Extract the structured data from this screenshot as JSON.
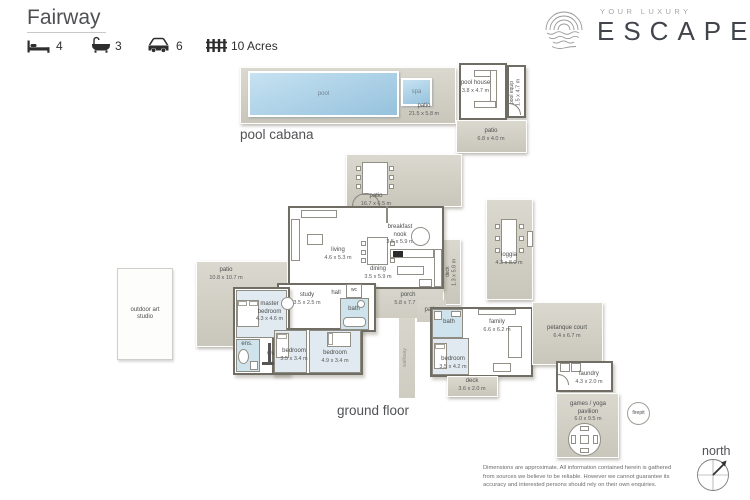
{
  "header": {
    "title": "Fairway",
    "beds": "4",
    "baths": "3",
    "cars": "6",
    "land": "10 Acres"
  },
  "logo": {
    "tagline": "YOUR LUXURY",
    "brand": "ESCAPE"
  },
  "pool_cabana": {
    "section_label": "pool cabana",
    "pool": "pool",
    "spa": "spa",
    "patio": {
      "name": "patio",
      "dims": "21.5 x 5.8 m"
    }
  },
  "pool_house": {
    "room": {
      "name": "pool house",
      "dims": "3.8 x 4.7 m"
    },
    "equip": {
      "name": "pool equip",
      "dims": "1.5 x 4.7 m"
    },
    "patio": {
      "name": "patio",
      "dims": "6.8 x 4.0 m"
    }
  },
  "gf": {
    "section_label": "ground floor",
    "patio_top": {
      "name": "patio",
      "dims": "16.7 x 6.5 m"
    },
    "living": {
      "name": "living",
      "dims": "4.6 x 5.3 m"
    },
    "dining": {
      "name": "dining",
      "dims": "3.5 x 5.9 m"
    },
    "breakfast": {
      "name": "breakfast nook",
      "dims": "3.5 x 5.9 m"
    },
    "porch": {
      "name": "porch",
      "dims": "5.8 x 7.7 m"
    },
    "patio_small": {
      "name": "patio"
    },
    "deck_side": {
      "name": "deck",
      "dims": "1.3 x 5.8 m"
    },
    "loggia": {
      "name": "loggia",
      "dims": "4.3 x 8.0 m"
    },
    "patio_left": {
      "name": "patio",
      "dims": "10.8 x 10.7 m"
    },
    "art_studio": {
      "name": "outdoor art studio"
    },
    "master": {
      "name": "master bedroom",
      "dims": "4.3 x 4.6 m"
    },
    "study": {
      "name": "study",
      "dims": "3.5 x 2.5 m"
    },
    "hall": {
      "name": "hall"
    },
    "wc": {
      "name": "wc"
    },
    "bath_main": {
      "name": "bath"
    },
    "ens": {
      "name": "ens."
    },
    "wir": {
      "name": "wir"
    },
    "bedroom2": {
      "name": "bedroom",
      "dims": "3.5 x 3.4 m"
    },
    "bedroom3": {
      "name": "bedroom",
      "dims": "4.9 x 3.4 m"
    },
    "bath_family": {
      "name": "bath"
    },
    "family": {
      "name": "family",
      "dims": "6.6 x 6.2 m"
    },
    "bedroom4": {
      "name": "bedroom",
      "dims": "3.5 x 4.2 m"
    },
    "deck_bottom": {
      "name": "deck",
      "dims": "3.6 x 2.0 m"
    },
    "petanque": {
      "name": "petanque court",
      "dims": "6.4 x 6.7 m"
    },
    "laundry": {
      "name": "laundry",
      "dims": "4.3 x 2.0 m"
    },
    "pavilion": {
      "name": "games / yoga pavilion",
      "dims": "6.0 x 9.5 m"
    },
    "firepit": {
      "name": "firepit"
    },
    "walkway": {
      "name": "walkway"
    }
  },
  "footer": {
    "disclaimer": [
      "Dimensions are approximate.  All information contained herein is gathered",
      "from sources we believe to be reliable.  However we cannot guarantee its",
      "accuracy and interested persons should rely on their own enquiries."
    ],
    "north": "north"
  },
  "colors": {
    "patio_beige": "#d4d1c6",
    "wall": "#6f6d64",
    "pool_water": "#a9cfe6",
    "bath_blue": "#cfe3ec",
    "bedroom_blue": "#e0eaf0"
  }
}
